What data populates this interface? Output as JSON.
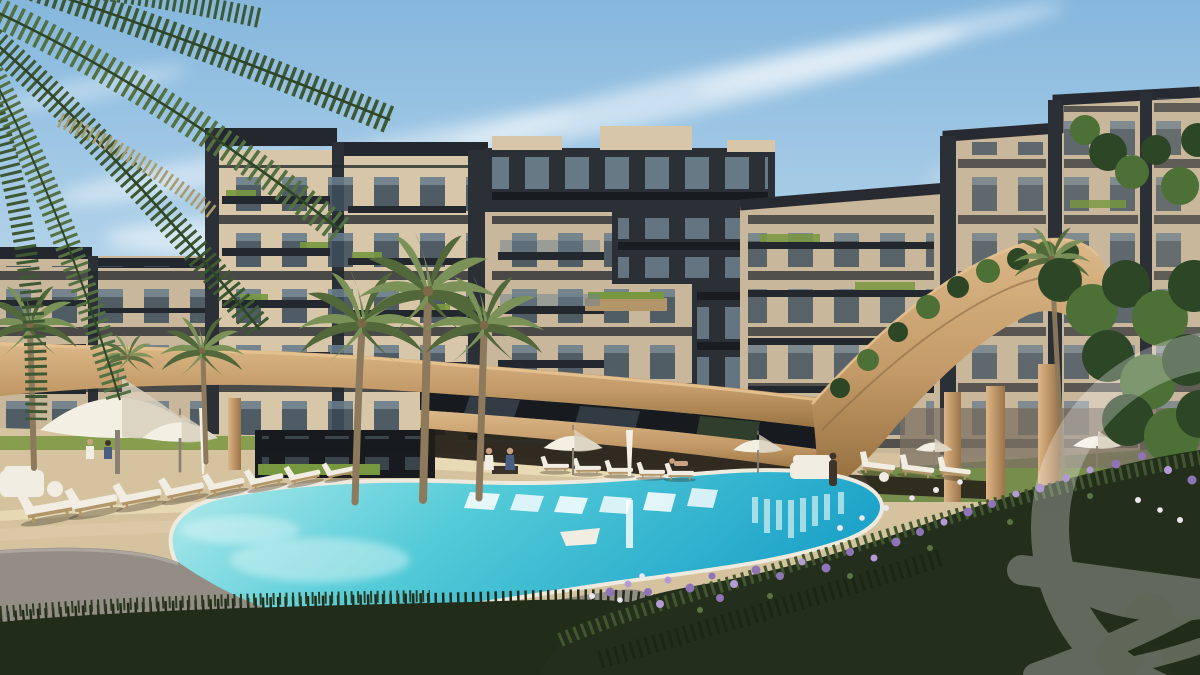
{
  "scene": {
    "type": "architectural-render",
    "description": "3D render of a modern residential compound courtyard: curved beige apartment buildings with dark accents around a free-form swimming pool, sun loungers, white umbrellas, palm trees, a sweeping tan canopy ramp, and flower beds",
    "visible_text": "none"
  },
  "palette": {
    "skyTop": "#85b7dd",
    "skyHorizon": "#d9eaf4",
    "facadeBeige": "#c9b79b",
    "facadeBeigeLight": "#d8c6a9",
    "facadeDark": "#2b3036",
    "slabDark": "#23282e",
    "windowGlass": "#3c4d5c",
    "windowReflection": "#8aa2b2",
    "glassDark": "#171b1f",
    "bandTanLight": "#dcb888",
    "bandTan": "#c39a68",
    "bandTanShadow": "#96713f",
    "columnLight": "#ddb586",
    "columnDark": "#9a7448",
    "deckBeige": "#d5c3a0",
    "deckLight": "#e9dab6",
    "pavementGray": "#938d86",
    "poolLight": "#b5ecec",
    "poolMid": "#54cbd8",
    "poolDeep": "#1ea4c9",
    "poolRim": "#efeade",
    "umbrellaWhite": "#f4efe3",
    "umbrellaShade": "#d8d0bd",
    "loungerWhite": "#f1ede2",
    "woodBase": "#b2966a",
    "palmGreen": "#7a9158",
    "palmGreenDark": "#52683a",
    "palmTrunk": "#8d7a5c",
    "frondDark": "#3d5832",
    "frondMid": "#537142",
    "frondDry": "#ac9a69",
    "foliageDark": "#2d4626",
    "foliageMid": "#4d7036",
    "grassDark": "#212d18",
    "hedgeGreen": "#78983f",
    "lawnGreen": "#6d8743",
    "flowerPurple": "#8f74b8",
    "flowerPurpleLight": "#b49bd3",
    "flowerWhite": "#ebe8f1",
    "shadeDark": "#221d16",
    "skinTone": "#c9a183",
    "figureDark": "#3d342c",
    "figureBlue": "#4a5d82",
    "watermarkColor": "#ffffff"
  },
  "watermark": {
    "description": "large translucent circular logo mark with horizontal bar and sweeping curved strokes, cropped by the right edge",
    "opacity": 0.28
  }
}
